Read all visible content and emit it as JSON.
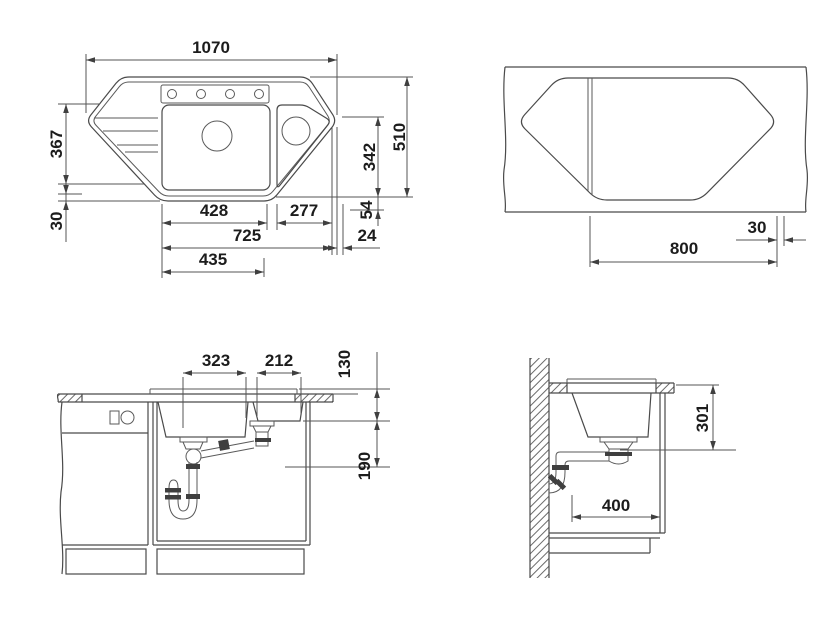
{
  "drawing": {
    "type": "corner sink installation drawing",
    "views": {
      "sink_top": {
        "label": "sink top view",
        "dims": {
          "overall_width": "1070",
          "left_depth": "367",
          "left_offset": "30",
          "main_bowl_width": "428",
          "side_bowl_width": "277",
          "inner_width": "725",
          "lower_width": "435",
          "inner_depth": "342",
          "overall_depth": "510",
          "bottom_offset": "54",
          "corner_offset": "24"
        }
      },
      "cutout": {
        "label": "worktop cutout view",
        "dims": {
          "cutout_width": "800",
          "edge_offset": "30"
        }
      },
      "front": {
        "label": "front section view",
        "dims": {
          "main_bowl_width": "323",
          "side_bowl_width": "212",
          "side_bowl_depth": "130",
          "drain_height": "190"
        }
      },
      "side": {
        "label": "side section view",
        "dims": {
          "bowl_depth": "301",
          "drain_distance": "400"
        }
      }
    }
  }
}
